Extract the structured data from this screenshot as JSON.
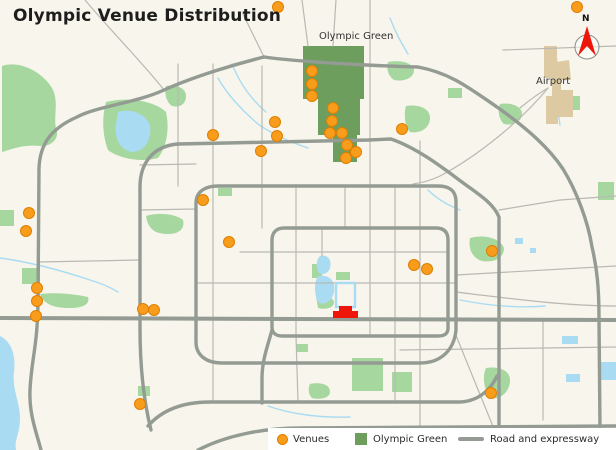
{
  "title": "Olympic Venue Distribution",
  "map": {
    "labels": {
      "olympic_green": "Olympic Green",
      "airport": "Airport",
      "compass_north": "N"
    }
  },
  "legend": {
    "items": [
      {
        "label": "Venues",
        "symbol": "venue-dot"
      },
      {
        "label": "Olympic Green",
        "symbol": "olympic-green-square"
      },
      {
        "label": "Road and expressway",
        "symbol": "road-line"
      }
    ]
  },
  "colors": {
    "background": "#f7f5ec",
    "park": "#a5d79f",
    "water": "#a9dcf2",
    "olympic_green": "#6d9e5e",
    "road_major": "#939b93",
    "road_minor": "#b9b9b3",
    "venue_fill": "#f89c1c",
    "venue_stroke": "#e07f00",
    "airport": "#decaa2",
    "landmark_red": "#ee1509",
    "legend_bg": "#ffffff",
    "text": "#333333"
  },
  "venues": {
    "count": 31,
    "radius": 5.5,
    "points": [
      [
        278,
        7
      ],
      [
        577,
        7
      ],
      [
        312,
        71
      ],
      [
        312,
        84
      ],
      [
        312,
        96
      ],
      [
        333,
        108
      ],
      [
        332,
        121
      ],
      [
        330,
        133
      ],
      [
        342,
        133
      ],
      [
        347,
        145
      ],
      [
        356,
        152
      ],
      [
        346,
        158
      ],
      [
        402,
        129
      ],
      [
        275,
        122
      ],
      [
        277,
        136
      ],
      [
        261,
        151
      ],
      [
        213,
        135
      ],
      [
        203,
        200
      ],
      [
        229,
        242
      ],
      [
        29,
        213
      ],
      [
        26,
        231
      ],
      [
        37,
        288
      ],
      [
        37,
        301
      ],
      [
        36,
        316
      ],
      [
        143,
        309
      ],
      [
        154,
        310
      ],
      [
        414,
        265
      ],
      [
        427,
        269
      ],
      [
        492,
        251
      ],
      [
        140,
        404
      ],
      [
        491,
        393
      ]
    ]
  }
}
